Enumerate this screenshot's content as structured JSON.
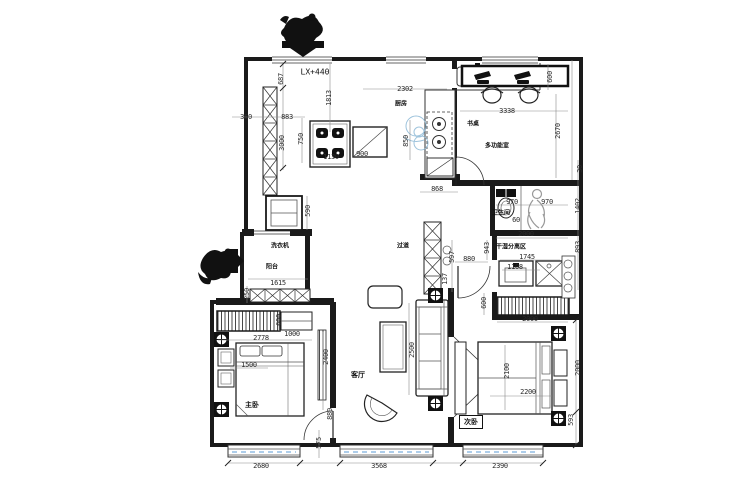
{
  "drawing": {
    "level_label": "LX+440",
    "rooms": {
      "kitchen": "厨房",
      "desk": "书桌",
      "multi_room": "多功能室",
      "bathroom": "卫生间",
      "dry_zone": "干湿分离区",
      "corridor": "过道",
      "washer": "洗衣机",
      "balcony": "阳台",
      "living_room": "客厅",
      "master_bedroom": "主卧",
      "second_bedroom": "次卧"
    },
    "colors": {
      "wall_line": "#1a1a1a",
      "dim_text": "#2b2b2b",
      "window_blue": "#5b9bd5",
      "watermark_blue": "#8db9d6",
      "figure_gray": "#999999"
    },
    "dimensions": [
      {
        "text": "350",
        "x": 246,
        "y": 117
      },
      {
        "text": "883",
        "x": 287,
        "y": 117
      },
      {
        "text": "687",
        "x": 281,
        "y": 79,
        "v": 1
      },
      {
        "text": "3000",
        "x": 282,
        "y": 143,
        "v": 1
      },
      {
        "text": "1813",
        "x": 329,
        "y": 98,
        "v": 1
      },
      {
        "text": "750",
        "x": 301,
        "y": 139,
        "v": 1
      },
      {
        "text": "1130",
        "x": 331,
        "y": 157
      },
      {
        "text": "900",
        "x": 362,
        "y": 154
      },
      {
        "text": "850",
        "x": 406,
        "y": 141,
        "v": 1
      },
      {
        "text": "2302",
        "x": 405,
        "y": 89
      },
      {
        "text": "600",
        "x": 550,
        "y": 77,
        "v": 1
      },
      {
        "text": "3338",
        "x": 507,
        "y": 111
      },
      {
        "text": "2670",
        "x": 558,
        "y": 131,
        "v": 1
      },
      {
        "text": "30",
        "x": 580,
        "y": 169,
        "v": 1
      },
      {
        "text": "1402",
        "x": 578,
        "y": 206,
        "v": 1
      },
      {
        "text": "868",
        "x": 437,
        "y": 189
      },
      {
        "text": "970",
        "x": 512,
        "y": 202
      },
      {
        "text": "970",
        "x": 547,
        "y": 202
      },
      {
        "text": "60",
        "x": 516,
        "y": 220
      },
      {
        "text": "2000",
        "x": 526,
        "y": 234
      },
      {
        "text": "943",
        "x": 487,
        "y": 248,
        "v": 1
      },
      {
        "text": "1745",
        "x": 527,
        "y": 257
      },
      {
        "text": "1108",
        "x": 515,
        "y": 267
      },
      {
        "text": "893",
        "x": 578,
        "y": 247,
        "v": 1
      },
      {
        "text": "880",
        "x": 469,
        "y": 259
      },
      {
        "text": "597",
        "x": 452,
        "y": 257,
        "v": 1
      },
      {
        "text": "137",
        "x": 445,
        "y": 279,
        "v": 1
      },
      {
        "text": "590",
        "x": 308,
        "y": 211,
        "v": 1
      },
      {
        "text": "1615",
        "x": 278,
        "y": 283
      },
      {
        "text": "250",
        "x": 247,
        "y": 294,
        "v": 1
      },
      {
        "text": "600",
        "x": 279,
        "y": 320,
        "v": 1
      },
      {
        "text": "2778",
        "x": 261,
        "y": 338
      },
      {
        "text": "1000",
        "x": 292,
        "y": 334
      },
      {
        "text": "1500",
        "x": 249,
        "y": 365
      },
      {
        "text": "2400",
        "x": 326,
        "y": 357,
        "v": 1
      },
      {
        "text": "880",
        "x": 330,
        "y": 414,
        "v": 1
      },
      {
        "text": "575",
        "x": 319,
        "y": 443,
        "v": 1
      },
      {
        "text": "2500",
        "x": 412,
        "y": 350,
        "v": 1
      },
      {
        "text": "600",
        "x": 484,
        "y": 303,
        "v": 1
      },
      {
        "text": "2000",
        "x": 530,
        "y": 319
      },
      {
        "text": "2100",
        "x": 507,
        "y": 371,
        "v": 1
      },
      {
        "text": "2200",
        "x": 528,
        "y": 392
      },
      {
        "text": "2000",
        "x": 578,
        "y": 368,
        "v": 1
      },
      {
        "text": "593",
        "x": 571,
        "y": 420,
        "v": 1
      },
      {
        "text": "2680",
        "x": 261,
        "y": 466
      },
      {
        "text": "3568",
        "x": 379,
        "y": 466
      },
      {
        "text": "2390",
        "x": 500,
        "y": 466
      }
    ]
  }
}
